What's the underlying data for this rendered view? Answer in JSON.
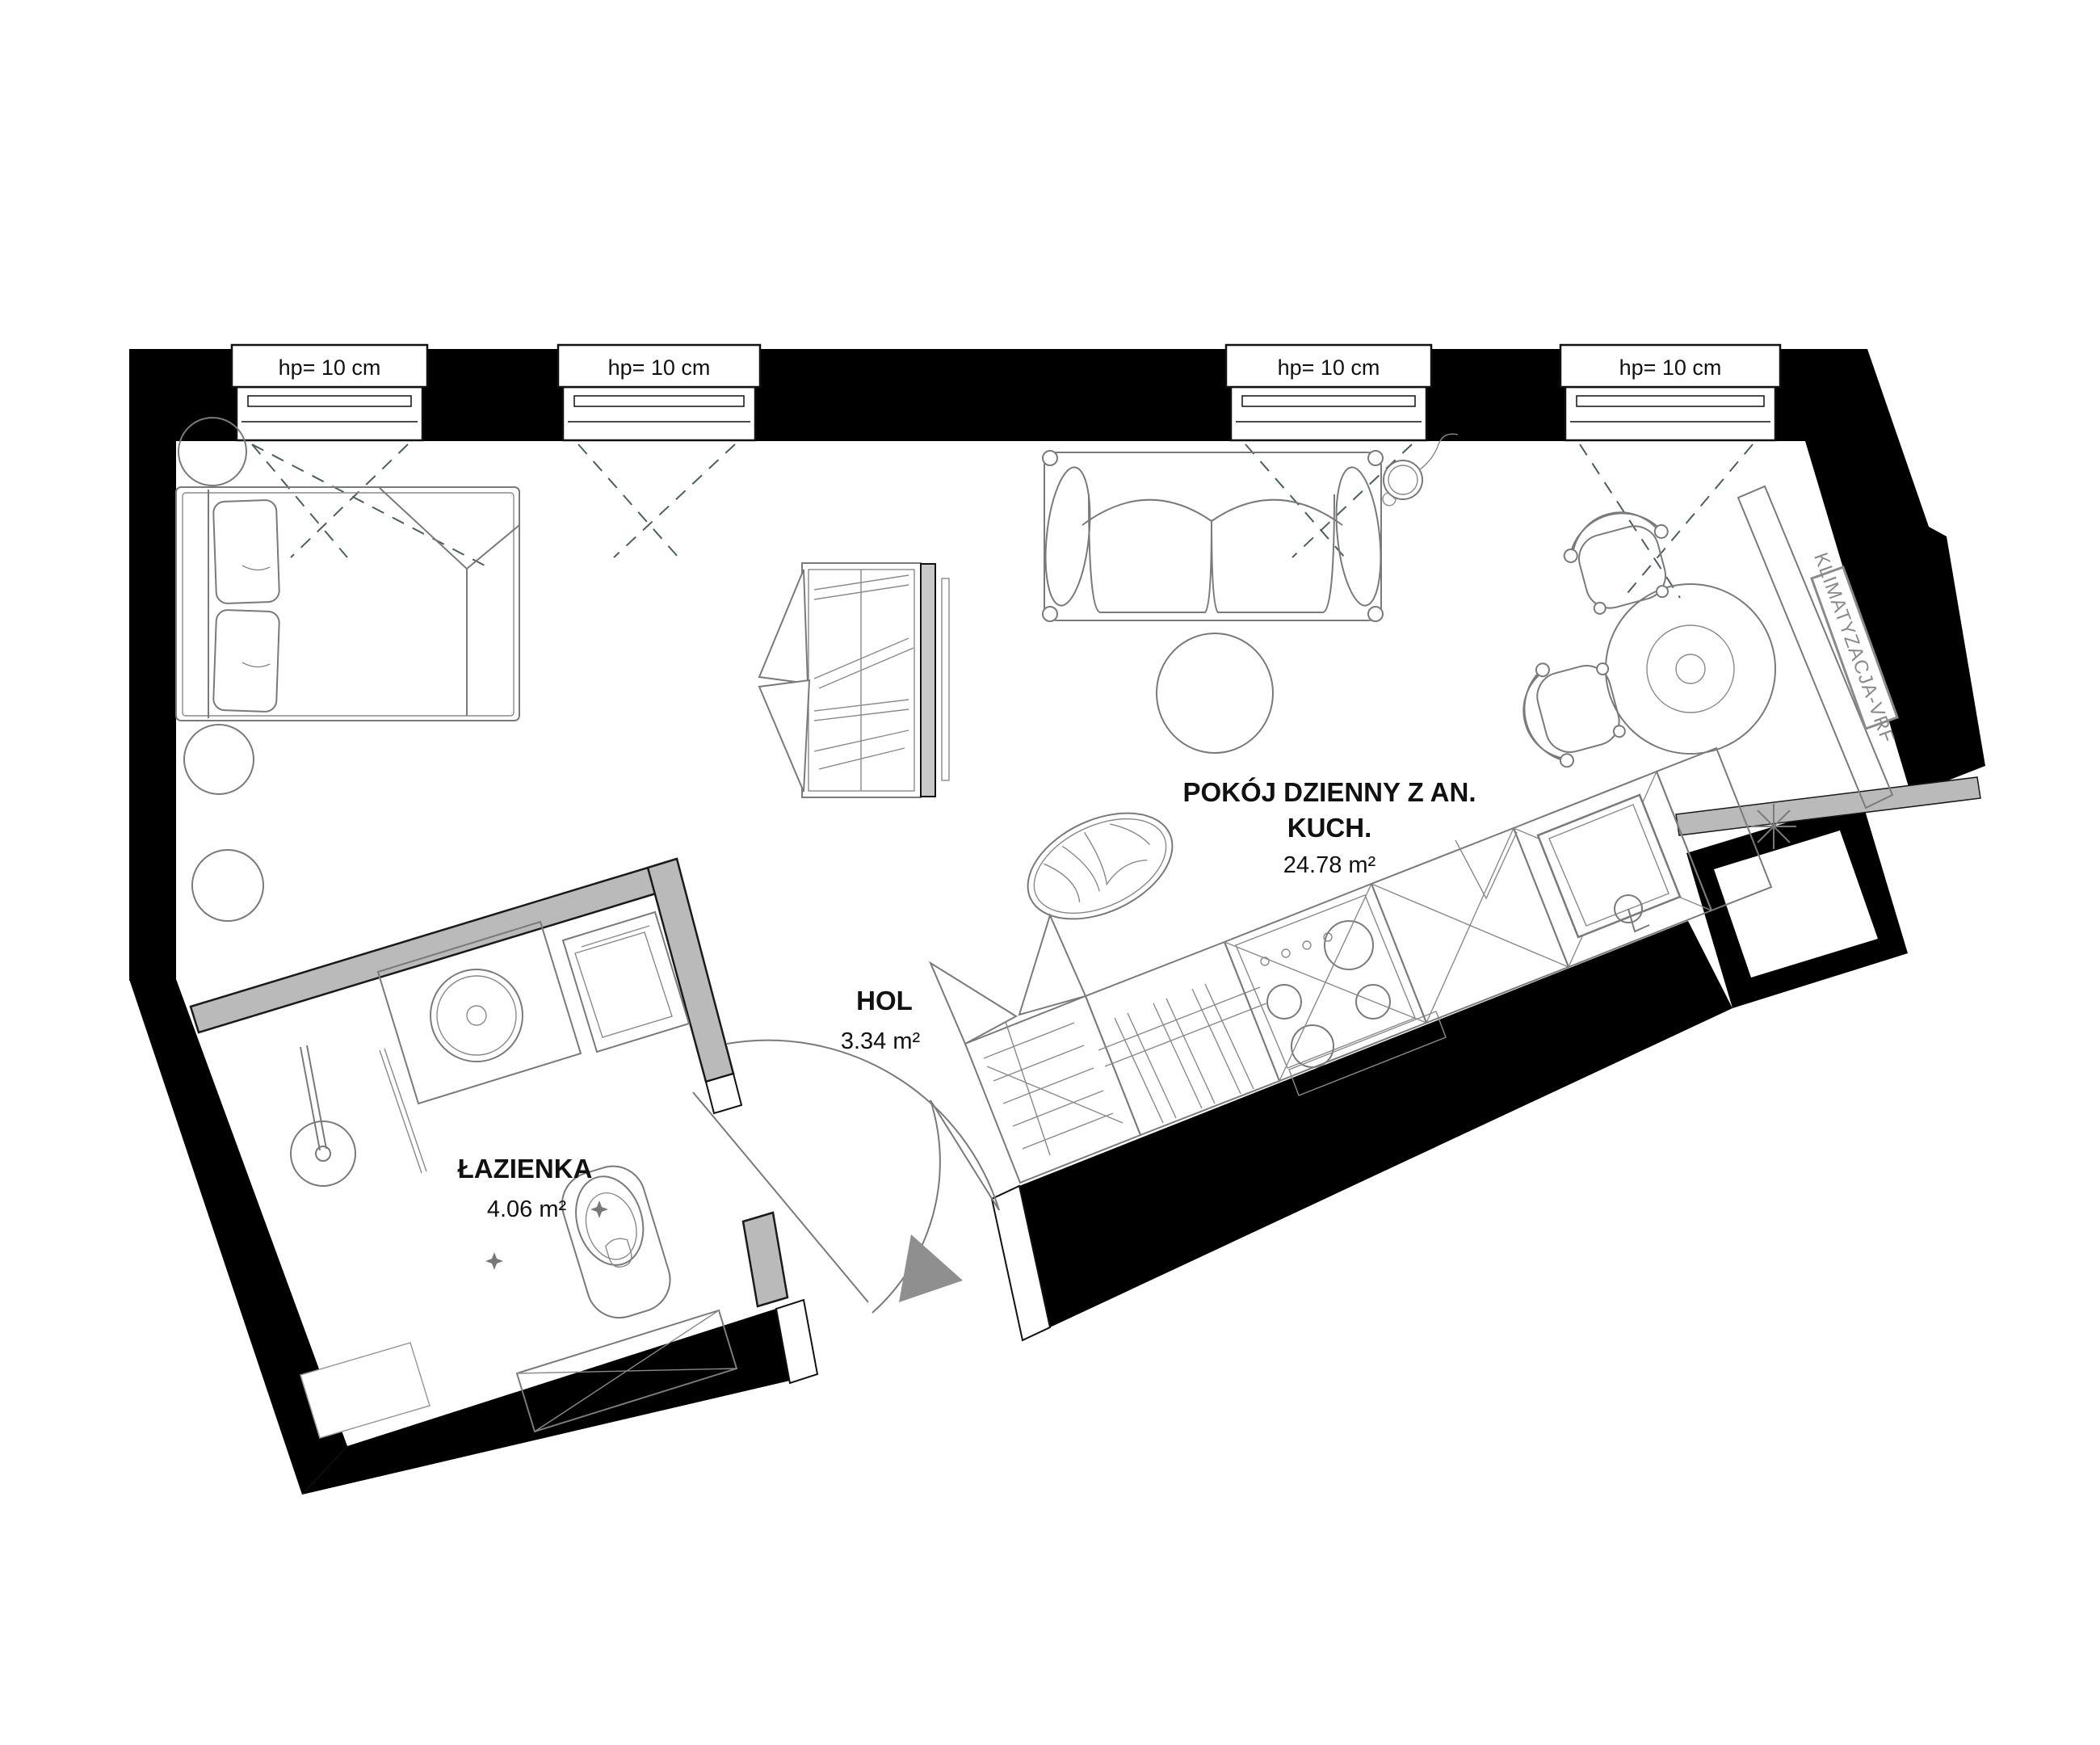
{
  "windows": [
    {
      "label": "hp= 10 cm"
    },
    {
      "label": "hp= 10 cm"
    },
    {
      "label": "hp= 10 cm"
    },
    {
      "label": "hp= 10 cm"
    }
  ],
  "rooms": {
    "living": {
      "name_line1": "POKÓJ DZIENNY Z AN.",
      "name_line2": "KUCH.",
      "area": "24.78 m²"
    },
    "hall": {
      "name": "HOL",
      "area": "3.34 m²"
    },
    "bathroom": {
      "name": "ŁAZIENKA",
      "area": "4.06 m²"
    }
  },
  "hvac": {
    "label": "KLIMATYZACJA-VRF"
  },
  "colors": {
    "wall": "#000000",
    "partition_fill": "#bababa",
    "entry_marker": "#8f8f8f",
    "furniture_line": "#7a7a7a",
    "hvac_text": "#8a8a8a",
    "opening_dash": "#4e5e5e",
    "tv_panel": "#c9c9c9"
  }
}
